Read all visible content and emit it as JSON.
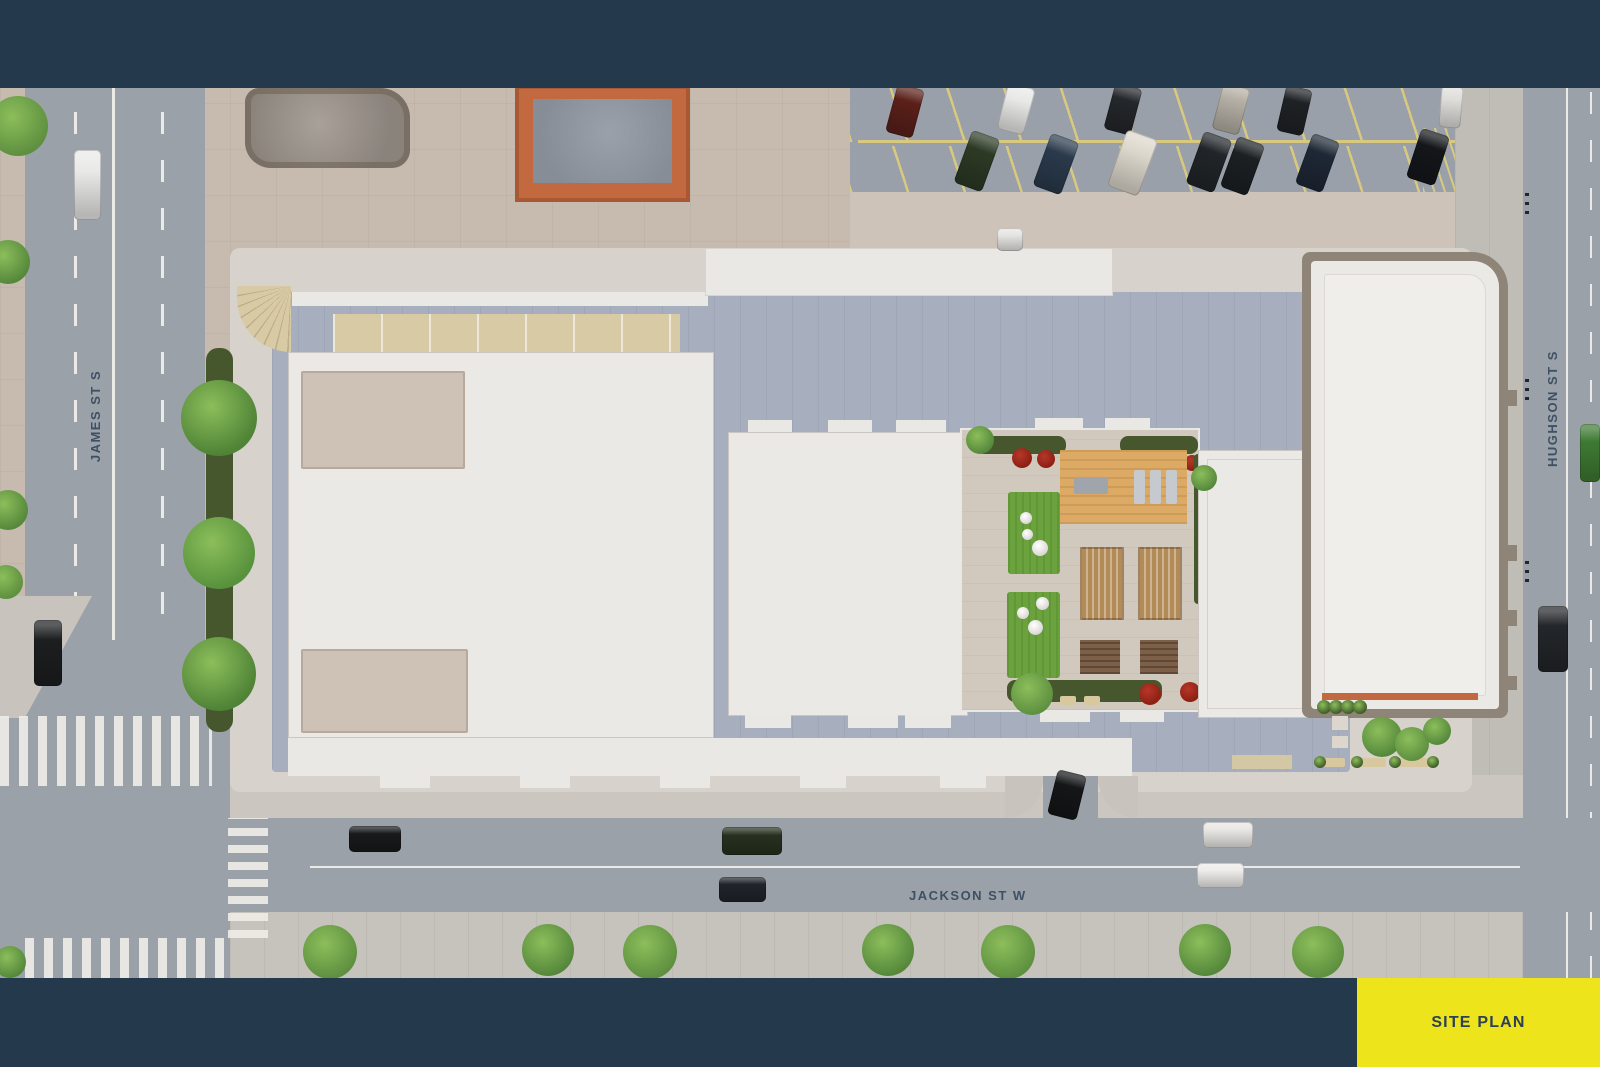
{
  "labels": {
    "west_street": "JAMES ST S",
    "east_street": "HUGHSON ST S",
    "south_street": "JACKSON ST W",
    "plan_tag": "SITE PLAN"
  },
  "colors": {
    "navy": "#25394C",
    "yellow": "#EEE41B",
    "label": "#31455C",
    "road": "#9BA1A8",
    "marking": "#ECEAE6",
    "sidewalk": "#C8C3BC",
    "plaza": "#C7BBAF",
    "plaza2": "#CDC3B9",
    "apron": "#D7D3CC",
    "podium": "#A7AEBE",
    "whitestrip": "#EAE8E4",
    "roof": "#EBE9E5",
    "roofborder": "#CBC6BF",
    "recess": "#CEC2B6",
    "cream": "#D8CAA4",
    "paver": "#D1C9BE",
    "lawn": "#6BA23E",
    "deck": "#DCAA64",
    "pergola": "#B28B56",
    "planter": "#7E6048",
    "hedge": "#46572E",
    "red": "#8E1F13",
    "taupe": "#8E8578",
    "orange": "#C2693F",
    "asphalt": "#99A0A9",
    "yline": "#D9C97E"
  },
  "scene": {
    "trees": [
      {
        "x": 18,
        "y": 126,
        "r": 30,
        "c": "#5E9040"
      },
      {
        "x": 8,
        "y": 262,
        "r": 22,
        "c": "#55883B"
      },
      {
        "x": 8,
        "y": 510,
        "r": 20,
        "c": "#55883B"
      },
      {
        "x": 6,
        "y": 582,
        "r": 17,
        "c": "#5E9040"
      },
      {
        "x": 10,
        "y": 962,
        "r": 16,
        "c": "#55883B"
      },
      {
        "x": 219,
        "y": 418,
        "r": 38,
        "c": "#4F8336"
      },
      {
        "x": 219,
        "y": 553,
        "r": 36,
        "c": "#57923C"
      },
      {
        "x": 219,
        "y": 674,
        "r": 37,
        "c": "#4F8336"
      },
      {
        "x": 330,
        "y": 952,
        "r": 27,
        "c": "#5E9040"
      },
      {
        "x": 548,
        "y": 950,
        "r": 26,
        "c": "#55883B"
      },
      {
        "x": 650,
        "y": 952,
        "r": 27,
        "c": "#5E9040"
      },
      {
        "x": 888,
        "y": 950,
        "r": 26,
        "c": "#55883B"
      },
      {
        "x": 1008,
        "y": 952,
        "r": 27,
        "c": "#5E9040"
      },
      {
        "x": 1205,
        "y": 950,
        "r": 26,
        "c": "#55883B"
      },
      {
        "x": 1318,
        "y": 952,
        "r": 26,
        "c": "#5E9040"
      },
      {
        "x": 1382,
        "y": 737,
        "r": 20,
        "c": "#55883B"
      },
      {
        "x": 1412,
        "y": 744,
        "r": 17,
        "c": "#5E9040"
      },
      {
        "x": 1437,
        "y": 731,
        "r": 14,
        "c": "#55883B"
      },
      {
        "x": 1324,
        "y": 707,
        "r": 7,
        "c": "#3F5A28"
      },
      {
        "x": 1336,
        "y": 707,
        "r": 7,
        "c": "#3F5A28"
      },
      {
        "x": 1348,
        "y": 707,
        "r": 7,
        "c": "#3F5A28"
      },
      {
        "x": 1360,
        "y": 707,
        "r": 7,
        "c": "#3F5A28"
      },
      {
        "x": 1320,
        "y": 762,
        "r": 6,
        "c": "#3F5A28"
      },
      {
        "x": 1357,
        "y": 762,
        "r": 6,
        "c": "#3F5A28"
      },
      {
        "x": 1395,
        "y": 762,
        "r": 6,
        "c": "#3F5A28"
      },
      {
        "x": 1433,
        "y": 762,
        "r": 6,
        "c": "#3F5A28"
      },
      {
        "x": 1032,
        "y": 694,
        "r": 21,
        "c": "#5E9040"
      },
      {
        "x": 980,
        "y": 440,
        "r": 14,
        "c": "#55883B"
      },
      {
        "x": 1204,
        "y": 478,
        "r": 13,
        "c": "#55883B"
      }
    ],
    "cars": [
      {
        "n": "car-james-white",
        "x": 74,
        "y": 150,
        "w": 27,
        "h": 70,
        "rot": 0,
        "c": "#E9E9E7"
      },
      {
        "n": "car-james-black",
        "x": 34,
        "y": 620,
        "w": 28,
        "h": 66,
        "rot": 0,
        "c": "#1C1E20"
      },
      {
        "n": "car-jackson-black",
        "x": 349,
        "y": 826,
        "w": 52,
        "h": 26,
        "rot": 0,
        "c": "#17191B"
      },
      {
        "n": "car-jackson-green",
        "x": 722,
        "y": 827,
        "w": 60,
        "h": 28,
        "rot": 0,
        "c": "#26301F"
      },
      {
        "n": "car-jackson-convertible",
        "x": 719,
        "y": 877,
        "w": 47,
        "h": 25,
        "rot": 0,
        "c": "#20242A"
      },
      {
        "n": "car-jackson-white-1",
        "x": 1203,
        "y": 822,
        "w": 50,
        "h": 26,
        "rot": 0,
        "c": "#E8E7E4"
      },
      {
        "n": "car-jackson-white-2",
        "x": 1197,
        "y": 863,
        "w": 47,
        "h": 25,
        "rot": 0,
        "c": "#EDECE9"
      },
      {
        "n": "car-hughson-green",
        "x": 1580,
        "y": 424,
        "w": 20,
        "h": 58,
        "rot": 0,
        "c": "#3E7A33"
      },
      {
        "n": "car-hughson-suv",
        "x": 1538,
        "y": 606,
        "w": 30,
        "h": 66,
        "rot": 0,
        "c": "#23262A"
      },
      {
        "n": "car-driveway",
        "x": 1052,
        "y": 772,
        "w": 30,
        "h": 46,
        "rot": 14,
        "c": "#141617"
      },
      {
        "n": "car-plaza",
        "x": 997,
        "y": 228,
        "w": 26,
        "h": 23,
        "rot": 0,
        "c": "#E6E5E2"
      },
      {
        "n": "car-lot-1",
        "x": 891,
        "y": 86,
        "w": 28,
        "h": 50,
        "rot": 15,
        "c": "#5A2019"
      },
      {
        "n": "car-lot-2",
        "x": 1002,
        "y": 85,
        "w": 28,
        "h": 48,
        "rot": 15,
        "c": "#E8E8E6"
      },
      {
        "n": "car-lot-3",
        "x": 1109,
        "y": 85,
        "w": 28,
        "h": 48,
        "rot": 15,
        "c": "#24272B"
      },
      {
        "n": "car-lot-4",
        "x": 1217,
        "y": 85,
        "w": 28,
        "h": 48,
        "rot": 15,
        "c": "#B4AFA4"
      },
      {
        "n": "car-lot-5",
        "x": 1281,
        "y": 87,
        "w": 27,
        "h": 47,
        "rot": 13,
        "c": "#1F2225"
      },
      {
        "n": "car-lot-6",
        "x": 1440,
        "y": 86,
        "w": 22,
        "h": 42,
        "rot": 5,
        "c": "#DFDEDA"
      },
      {
        "n": "car-lot-7",
        "x": 962,
        "y": 133,
        "w": 30,
        "h": 56,
        "rot": 20,
        "c": "#2C3A25"
      },
      {
        "n": "car-lot-8",
        "x": 1041,
        "y": 136,
        "w": 30,
        "h": 56,
        "rot": 20,
        "c": "#2A3A4C"
      },
      {
        "n": "car-lot-9",
        "x": 1116,
        "y": 133,
        "w": 33,
        "h": 60,
        "rot": 20,
        "c": "#DCD7CC"
      },
      {
        "n": "car-lot-10",
        "x": 1194,
        "y": 134,
        "w": 30,
        "h": 56,
        "rot": 20,
        "c": "#212529"
      },
      {
        "n": "car-lot-11",
        "x": 1228,
        "y": 139,
        "w": 29,
        "h": 54,
        "rot": 20,
        "c": "#1C2023"
      },
      {
        "n": "car-lot-12",
        "x": 1303,
        "y": 136,
        "w": 29,
        "h": 54,
        "rot": 20,
        "c": "#1E2836"
      },
      {
        "n": "car-lot-13",
        "x": 1413,
        "y": 131,
        "w": 30,
        "h": 52,
        "rot": 18,
        "c": "#14171A"
      }
    ]
  }
}
